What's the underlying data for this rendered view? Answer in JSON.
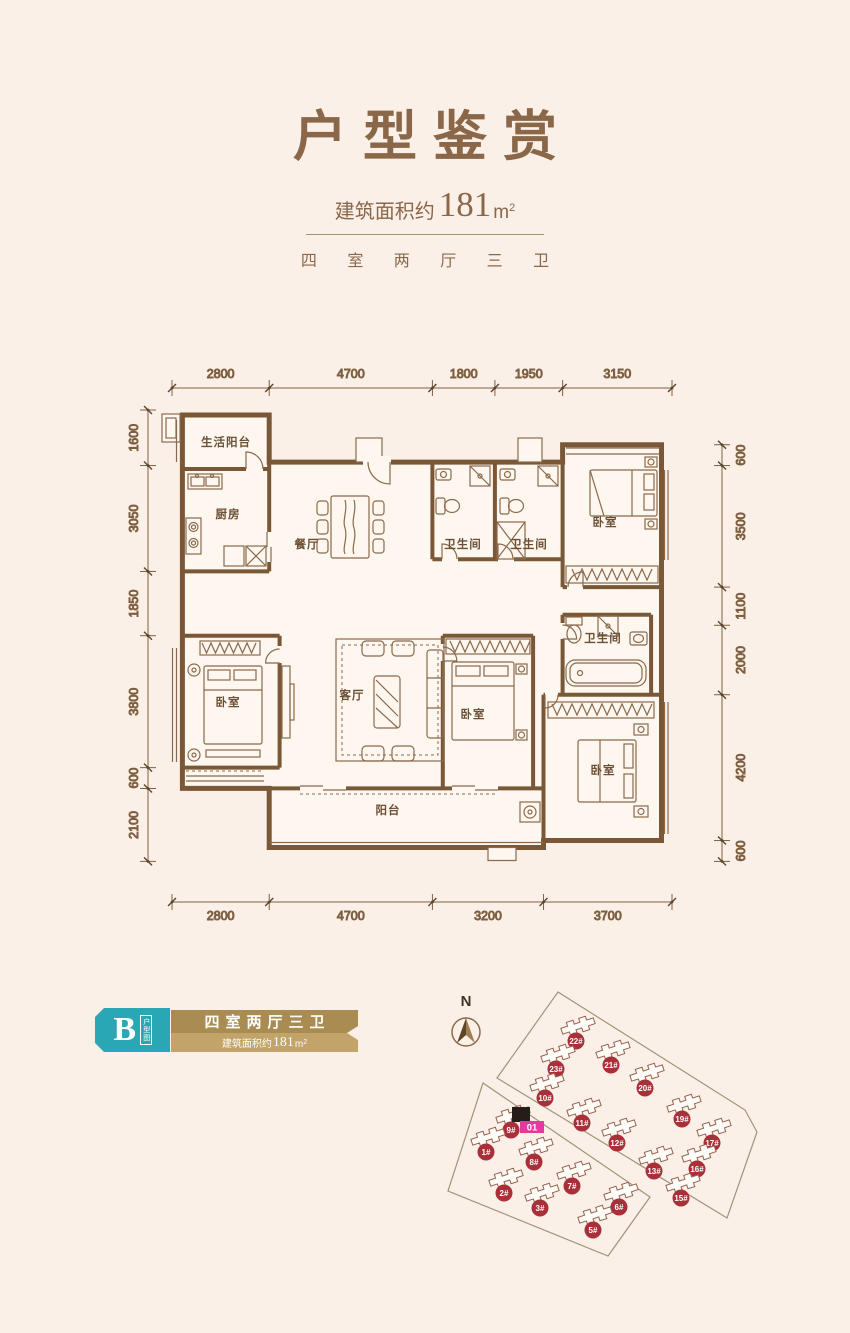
{
  "header": {
    "title": "户型鉴赏",
    "area_prefix": "建筑面积约",
    "area_value": "181",
    "area_unit": "m",
    "area_sup": "2",
    "layout_text": "四 室 两 厅 三 卫"
  },
  "floorplan": {
    "rooms": [
      {
        "name": "生活阳台",
        "x": 226,
        "y": 96
      },
      {
        "name": "厨房",
        "x": 228,
        "y": 168
      },
      {
        "name": "餐厅",
        "x": 307,
        "y": 198
      },
      {
        "name": "卫生间",
        "x": 463,
        "y": 198
      },
      {
        "name": "卫生间",
        "x": 529,
        "y": 198
      },
      {
        "name": "卧室",
        "x": 605,
        "y": 176
      },
      {
        "name": "卫生间",
        "x": 603,
        "y": 292
      },
      {
        "name": "卧室",
        "x": 228,
        "y": 356
      },
      {
        "name": "客厅",
        "x": 352,
        "y": 349
      },
      {
        "name": "卧室",
        "x": 473,
        "y": 368
      },
      {
        "name": "卧室",
        "x": 603,
        "y": 424
      },
      {
        "name": "阳台",
        "x": 388,
        "y": 464
      }
    ],
    "dims": {
      "top": {
        "values": [
          2800,
          4700,
          1800,
          1950,
          3150
        ]
      },
      "bottom": {
        "values": [
          2800,
          4700,
          3200,
          3700
        ]
      },
      "left": {
        "values": [
          1600,
          3050,
          1850,
          3800,
          600,
          2100
        ]
      },
      "right": {
        "values": [
          600,
          3500,
          1100,
          2000,
          4200,
          600
        ]
      }
    }
  },
  "unit_badge": {
    "letter": "B",
    "tag_vertical": "户型图",
    "title": "四室两厅三卫",
    "sub_prefix": "建筑面积约",
    "sub_value": "181",
    "sub_unit": "m",
    "sub_sup": "2"
  },
  "siteplan": {
    "north_label": "N",
    "highlight_label": "01",
    "parcels": [
      "128,12 315,130 327,152 297,238 67,98",
      "53,103 220,217 178,276 18,211"
    ],
    "buildings": [
      {
        "id": "22#",
        "x": 146,
        "y": 61
      },
      {
        "id": "21#",
        "x": 181,
        "y": 85
      },
      {
        "id": "23#",
        "x": 126,
        "y": 89
      },
      {
        "id": "20#",
        "x": 215,
        "y": 108
      },
      {
        "id": "10#",
        "x": 115,
        "y": 118
      },
      {
        "id": "11#",
        "x": 152,
        "y": 143
      },
      {
        "id": "19#",
        "x": 252,
        "y": 139
      },
      {
        "id": "12#",
        "x": 187,
        "y": 163
      },
      {
        "id": "17#",
        "x": 282,
        "y": 163
      },
      {
        "id": "9#",
        "x": 81,
        "y": 150
      },
      {
        "id": "1#",
        "x": 56,
        "y": 172
      },
      {
        "id": "8#",
        "x": 104,
        "y": 182
      },
      {
        "id": "13#",
        "x": 224,
        "y": 191
      },
      {
        "id": "16#",
        "x": 267,
        "y": 189
      },
      {
        "id": "2#",
        "x": 74,
        "y": 213
      },
      {
        "id": "7#",
        "x": 142,
        "y": 206
      },
      {
        "id": "15#",
        "x": 251,
        "y": 218
      },
      {
        "id": "3#",
        "x": 110,
        "y": 228
      },
      {
        "id": "6#",
        "x": 189,
        "y": 227
      },
      {
        "id": "5#",
        "x": 163,
        "y": 250
      }
    ]
  },
  "colors": {
    "background": "#fbf0e8",
    "title_brown": "#8a6749",
    "wall_brown": "#7a5837",
    "line_brown": "#8a6a4c",
    "dim_brown": "#7d5f41",
    "teal": "#2aa7b5",
    "gold_dark": "#a98c52",
    "gold_light": "#c2a369",
    "badge_red": "#a93039",
    "magenta": "#e23a9d",
    "highlight_black": "#241e17"
  }
}
